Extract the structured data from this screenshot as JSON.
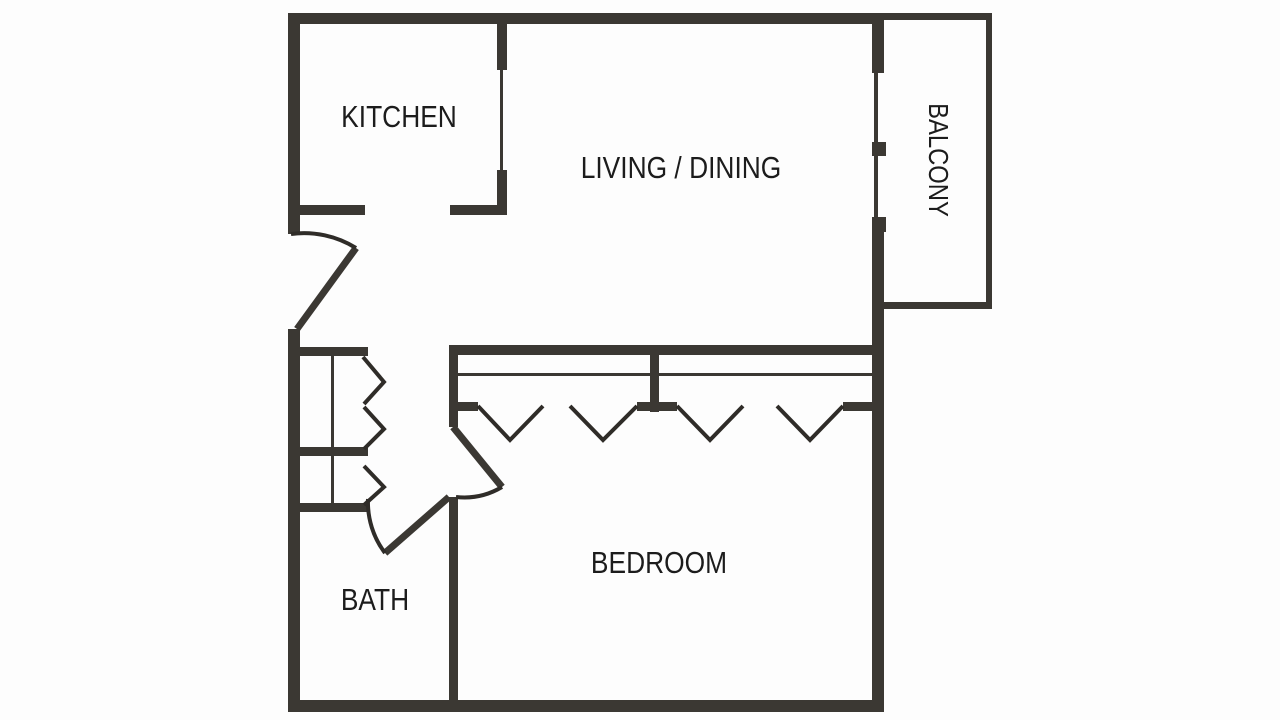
{
  "title": "Apartment floor plan",
  "colors": {
    "wall": "#3b3833",
    "line": "#2f2c28",
    "text": "#1c1c1c",
    "background": "#fdfdfd"
  },
  "rooms": {
    "kitchen": {
      "label": "KITCHEN"
    },
    "living_dining": {
      "label": "LIVING / DINING"
    },
    "balcony": {
      "label": "BALCONY"
    },
    "bath": {
      "label": "BATH"
    },
    "bedroom": {
      "label": "BEDROOM"
    }
  }
}
